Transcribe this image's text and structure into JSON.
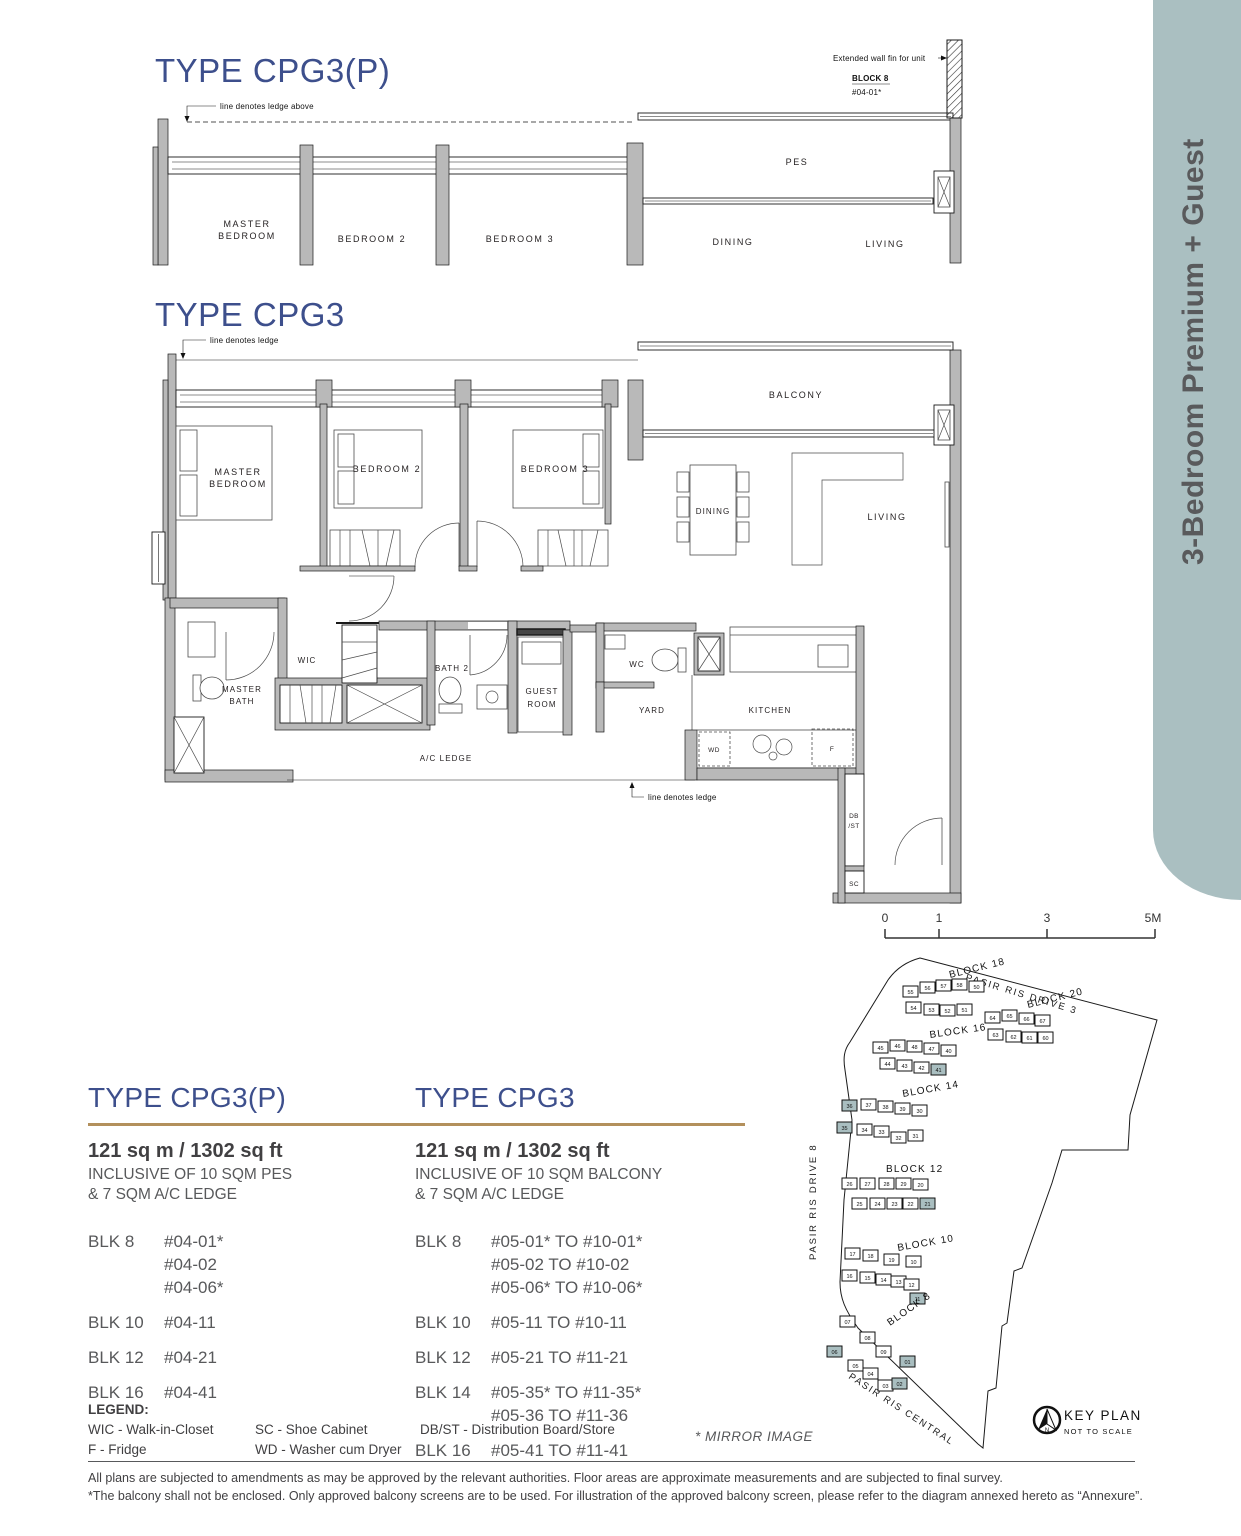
{
  "sidebar": {
    "label": "3-Bedroom Premium + Guest"
  },
  "colors": {
    "accent_blue": "#3d4f8c",
    "gold_rule": "#b3905c",
    "sidebar_band": "#aabfc1",
    "highlight_unit": "#a9bec0",
    "wall_gray": "#b9b9b9",
    "text_gray": "#58595b"
  },
  "plans": {
    "cpg3p": {
      "title": "TYPE CPG3(P)",
      "ledge_note": "line denotes ledge above",
      "fin_note": "Extended wall fin for unit",
      "fin_block": "BLOCK 8",
      "fin_unit": "#04-01*",
      "rooms": {
        "master1": "MASTER",
        "master2": "BEDROOM",
        "bed2": "BEDROOM 2",
        "bed3": "BEDROOM 3",
        "pes": "PES",
        "dining": "DINING",
        "living": "LIVING"
      }
    },
    "cpg3": {
      "title": "TYPE CPG3",
      "ledge_note": "line denotes ledge",
      "ledge_note_bottom": "line denotes ledge",
      "rooms": {
        "master1": "MASTER",
        "master2": "BEDROOM",
        "bed2": "BEDROOM 2",
        "bed3": "BEDROOM 3",
        "balcony": "BALCONY",
        "dining": "DINING",
        "living": "LIVING",
        "mbath1": "MASTER",
        "mbath2": "BATH",
        "wic": "WIC",
        "bath2": "BATH 2",
        "guest1": "GUEST",
        "guest2": "ROOM",
        "wc": "WC",
        "yard": "YARD",
        "kitchen": "KITCHEN",
        "wd": "WD",
        "f": "F",
        "db": "DB",
        "st": "/ST",
        "sc": "SC",
        "acledge": "A/C LEDGE"
      }
    }
  },
  "specs": {
    "left": {
      "title": "TYPE CPG3(P)",
      "area": "121 sq m / 1302 sq ft",
      "inc1": "INCLUSIVE OF 10 SQM PES",
      "inc2": "& 7 SQM A/C LEDGE",
      "rows": [
        {
          "blk": "BLK 8",
          "units": [
            "#04-01*",
            "#04-02",
            "#04-06*"
          ]
        },
        {
          "blk": "BLK 10",
          "units": [
            "#04-11"
          ]
        },
        {
          "blk": "BLK 12",
          "units": [
            "#04-21"
          ]
        },
        {
          "blk": "BLK 16",
          "units": [
            "#04-41"
          ]
        }
      ]
    },
    "right": {
      "title": "TYPE CPG3",
      "area": "121 sq m / 1302 sq ft",
      "inc1": "INCLUSIVE OF 10 SQM BALCONY",
      "inc2": "& 7 SQM A/C LEDGE",
      "rows": [
        {
          "blk": "BLK 8",
          "units": [
            "#05-01* TO #10-01*",
            "#05-02 TO #10-02",
            "#05-06* TO #10-06*"
          ]
        },
        {
          "blk": "BLK 10",
          "units": [
            "#05-11 TO #10-11"
          ]
        },
        {
          "blk": "BLK 12",
          "units": [
            "#05-21 TO #11-21"
          ]
        },
        {
          "blk": "BLK 14",
          "units": [
            "#05-35* TO #11-35*",
            "#05-36 TO #11-36"
          ]
        },
        {
          "blk": "BLK 16",
          "units": [
            "#05-41 TO #11-41"
          ]
        }
      ]
    }
  },
  "legend": {
    "heading": "LEGEND:",
    "columns": [
      [
        "WIC - Walk-in-Closet",
        "F - Fridge"
      ],
      [
        "SC - Shoe Cabinet",
        "WD - Washer cum Dryer"
      ],
      [
        "DB/ST - Distribution Board/Store"
      ]
    ]
  },
  "mirror_note": "* MIRROR IMAGE",
  "keyplan": {
    "title": "KEY PLAN",
    "subtitle": "NOT TO SCALE",
    "scale": [
      "0",
      "1",
      "3",
      "5M"
    ],
    "roads": [
      "PASIR RIS DRIVE 3",
      "PASIR RIS DRIVE 8",
      "PASIR RIS CENTRAL"
    ],
    "blocks": [
      {
        "name": "BLOCK 18",
        "lx": 150,
        "ly": 28,
        "lr": -14,
        "units": [
          {
            "n": "55",
            "x": 103,
            "y": 36
          },
          {
            "n": "56",
            "x": 120,
            "y": 32
          },
          {
            "n": "57",
            "x": 136,
            "y": 30
          },
          {
            "n": "58",
            "x": 152,
            "y": 29
          },
          {
            "n": "50",
            "x": 169,
            "y": 31
          },
          {
            "n": "54",
            "x": 106,
            "y": 52
          },
          {
            "n": "53",
            "x": 124,
            "y": 54
          },
          {
            "n": "52",
            "x": 140,
            "y": 55
          },
          {
            "n": "51",
            "x": 157,
            "y": 54
          }
        ]
      },
      {
        "name": "BLOCK 20",
        "lx": 228,
        "ly": 58,
        "lr": -14,
        "units": [
          {
            "n": "64",
            "x": 185,
            "y": 62
          },
          {
            "n": "65",
            "x": 202,
            "y": 60
          },
          {
            "n": "66",
            "x": 219,
            "y": 63
          },
          {
            "n": "67",
            "x": 235,
            "y": 65
          },
          {
            "n": "63",
            "x": 188,
            "y": 79
          },
          {
            "n": "62",
            "x": 206,
            "y": 81
          },
          {
            "n": "61",
            "x": 222,
            "y": 82
          },
          {
            "n": "60",
            "x": 238,
            "y": 82
          }
        ]
      },
      {
        "name": "BLOCK 16",
        "lx": 130,
        "ly": 88,
        "lr": -8,
        "units": [
          {
            "n": "45",
            "x": 73,
            "y": 92
          },
          {
            "n": "46",
            "x": 90,
            "y": 90
          },
          {
            "n": "48",
            "x": 107,
            "y": 91
          },
          {
            "n": "47",
            "x": 124,
            "y": 93
          },
          {
            "n": "40",
            "x": 141,
            "y": 95
          },
          {
            "n": "44",
            "x": 80,
            "y": 108
          },
          {
            "n": "43",
            "x": 97,
            "y": 110
          },
          {
            "n": "42",
            "x": 114,
            "y": 112
          },
          {
            "n": "41",
            "x": 131,
            "y": 114,
            "hl": true
          }
        ]
      },
      {
        "name": "BLOCK 14",
        "lx": 103,
        "ly": 147,
        "lr": -10,
        "units": [
          {
            "n": "36",
            "x": 42,
            "y": 150,
            "hl": true
          },
          {
            "n": "37",
            "x": 61,
            "y": 149
          },
          {
            "n": "38",
            "x": 78,
            "y": 151
          },
          {
            "n": "39",
            "x": 95,
            "y": 153
          },
          {
            "n": "30",
            "x": 112,
            "y": 155
          },
          {
            "n": "35",
            "x": 37,
            "y": 172,
            "hl": true
          },
          {
            "n": "34",
            "x": 57,
            "y": 174
          },
          {
            "n": "33",
            "x": 74,
            "y": 176
          },
          {
            "n": "32",
            "x": 91,
            "y": 182
          },
          {
            "n": "31",
            "x": 108,
            "y": 180
          }
        ]
      },
      {
        "name": "BLOCK 12",
        "lx": 86,
        "ly": 222,
        "lr": 0,
        "units": [
          {
            "n": "26",
            "x": 42,
            "y": 228
          },
          {
            "n": "27",
            "x": 60,
            "y": 228
          },
          {
            "n": "28",
            "x": 79,
            "y": 228
          },
          {
            "n": "29",
            "x": 96,
            "y": 228
          },
          {
            "n": "20",
            "x": 113,
            "y": 229
          },
          {
            "n": "25",
            "x": 52,
            "y": 248
          },
          {
            "n": "24",
            "x": 70,
            "y": 248
          },
          {
            "n": "23",
            "x": 87,
            "y": 248
          },
          {
            "n": "22",
            "x": 103,
            "y": 248
          },
          {
            "n": "21",
            "x": 120,
            "y": 248,
            "hl": true
          }
        ]
      },
      {
        "name": "BLOCK 10",
        "lx": 98,
        "ly": 301,
        "lr": -10,
        "units": [
          {
            "n": "17",
            "x": 45,
            "y": 298
          },
          {
            "n": "18",
            "x": 63,
            "y": 300
          },
          {
            "n": "19",
            "x": 84,
            "y": 304
          },
          {
            "n": "10",
            "x": 106,
            "y": 306
          },
          {
            "n": "16",
            "x": 42,
            "y": 320
          },
          {
            "n": "15",
            "x": 60,
            "y": 322
          },
          {
            "n": "14",
            "x": 76,
            "y": 324
          },
          {
            "n": "13",
            "x": 91,
            "y": 326
          },
          {
            "n": "12",
            "x": 104,
            "y": 329
          },
          {
            "n": "11",
            "x": 110,
            "y": 343,
            "hl": true
          }
        ]
      },
      {
        "name": "BLOCK 8",
        "lx": 90,
        "ly": 376,
        "lr": -35,
        "units": [
          {
            "n": "07",
            "x": 40,
            "y": 366
          },
          {
            "n": "08",
            "x": 60,
            "y": 382
          },
          {
            "n": "09",
            "x": 76,
            "y": 396
          },
          {
            "n": "06",
            "x": 27,
            "y": 396,
            "hl": true
          },
          {
            "n": "05",
            "x": 48,
            "y": 410
          },
          {
            "n": "04",
            "x": 63,
            "y": 418
          },
          {
            "n": "03",
            "x": 78,
            "y": 430
          },
          {
            "n": "01",
            "x": 100,
            "y": 406,
            "hl": true
          },
          {
            "n": "02",
            "x": 92,
            "y": 428,
            "hl": true
          }
        ]
      }
    ]
  },
  "disclaimer": {
    "line1": "All plans are subjected to amendments as may be approved by the relevant authorities. Floor areas are approximate measurements and are subjected to final survey.",
    "line2": "*The balcony shall not be enclosed. Only approved balcony screens are to be used. For illustration of the approved balcony screen, please refer to the diagram annexed hereto as “Annexure”."
  }
}
